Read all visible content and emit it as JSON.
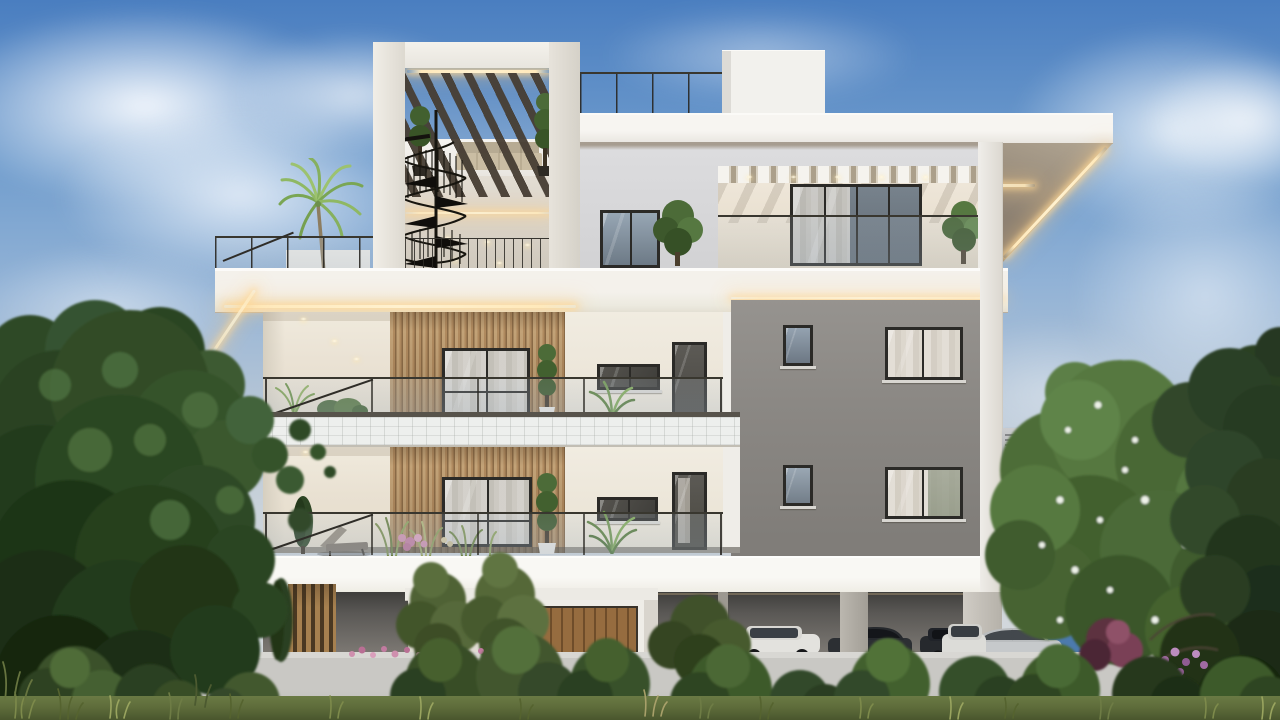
{
  "scene": {
    "title": "3D architectural render of a modern three-storey apartment building at dusk, with rooftop pergola, spiral staircase, wood-slat balconies, LED cove lighting, garden wall, parked cars and lush trees",
    "type": "architectural-exterior-render",
    "time_of_day": "dusk",
    "weather": "partly cloudy blue sky",
    "palette": {
      "sky_top": "#4a7ec0",
      "sky_mid": "#b3c4d6",
      "sky_horizon": "#d8dbdd",
      "cloud_white": "#f4f7fa",
      "wall_white": "#f2efe9",
      "wall_cream": "#efeade",
      "slab_white": "#f8f6f2",
      "penthouse_gray": "#d7d8da",
      "wing_gray": "#8c8985",
      "recess_cream": "#ede6d8",
      "frame_dark": "#2b2a27",
      "glass_blue": "#8fa0b2",
      "glass_dark": "#5f6a72",
      "wood_light": "#c2a277",
      "wood_dark": "#8b6b47",
      "door_wood": "#966c3f",
      "led_warm": "#ffe9bb",
      "garage_dark": "#474543",
      "wall_concrete": "#c9c8c4",
      "foliage_dark": "#223a1d",
      "foliage_mid": "#42602f",
      "foliage_light": "#6f944e",
      "palm_green": "#8fb863",
      "grass_olive": "#5d6b3a",
      "flower_pink": "#cf8fae",
      "flower_purple": "#a06aa2",
      "bush_red": "#6d3a4c",
      "car_white": "#e3e2de",
      "car_silver": "#c6c9cb",
      "car_blue": "#4c7aad",
      "car_dark": "#2c2f33",
      "car_red": "#8c3b33"
    },
    "elements": {
      "building": [
        "rooftop pergola tower with LED strip",
        "black spiral staircase",
        "roof terrace with glass railing",
        "palm tree on roof terrace",
        "rooftop sofa and topiary planters",
        "penthouse terrace with white pergola beams and glass sliding doors",
        "LED cove lighting under slabs",
        "vertical wood-slat cladding",
        "two balcony floors with glass balustrades",
        "gray side wing with four windows",
        "covered ground-floor parking on pillars",
        "roof parapet box",
        "air-conditioning unit on side wall"
      ],
      "site": [
        "white garden wall",
        "entrance volume with wooden door",
        "wooden louver screen"
      ],
      "vegetation": [
        "large dark tree on the left",
        "flowering tree with white blossoms on the right",
        "dark conifers at right edge",
        "row of round shrubs along the wall",
        "ornamental grasses and pink flowers",
        "small cypress and potted plants on balconies"
      ],
      "vehicles": [
        "white SUV in carport",
        "dark sedan in carport",
        "blue SUV on street",
        "silver sedan on street",
        "white car on street",
        "red car at right edge"
      ]
    }
  }
}
